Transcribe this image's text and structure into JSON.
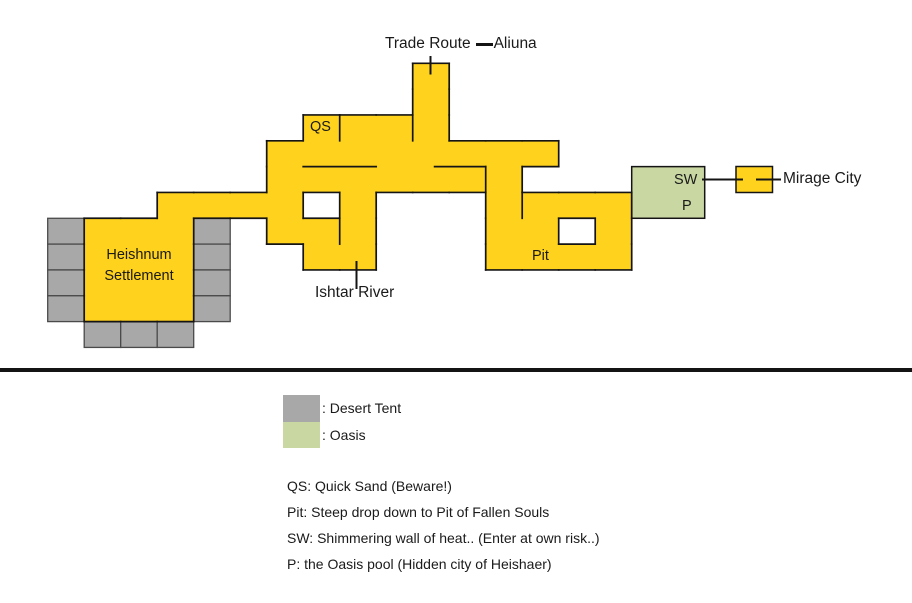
{
  "map": {
    "colors": {
      "path_fill": "#FFD21E",
      "outline": "#141414",
      "tent_fill": "#A8A8A8",
      "tent_stroke": "#4a4a4a",
      "oasis_fill": "#C9D7A2"
    },
    "grid": {
      "origin_x": 47.7,
      "origin_y": 63.3,
      "cell_w": 36.5,
      "cell_h": 25.83
    },
    "yellow_cells": [
      [
        10,
        0
      ],
      [
        10,
        1
      ],
      [
        7,
        2
      ],
      [
        8,
        2
      ],
      [
        9,
        2
      ],
      [
        10,
        2
      ],
      [
        6,
        3
      ],
      [
        7,
        3
      ],
      [
        8,
        3
      ],
      [
        9,
        3
      ],
      [
        10,
        3
      ],
      [
        11,
        3
      ],
      [
        12,
        3
      ],
      [
        13,
        3
      ],
      [
        6,
        4
      ],
      [
        7,
        4
      ],
      [
        8,
        4
      ],
      [
        9,
        4
      ],
      [
        10,
        4
      ],
      [
        11,
        4
      ],
      [
        12,
        4
      ],
      [
        3,
        5
      ],
      [
        4,
        5
      ],
      [
        5,
        5
      ],
      [
        6,
        5
      ],
      [
        8,
        5
      ],
      [
        12,
        5
      ],
      [
        13,
        5
      ],
      [
        14,
        5
      ],
      [
        15,
        5
      ],
      [
        1,
        6
      ],
      [
        2,
        6
      ],
      [
        3,
        6
      ],
      [
        6,
        6
      ],
      [
        7,
        6
      ],
      [
        8,
        6
      ],
      [
        12,
        6
      ],
      [
        13,
        6
      ],
      [
        15,
        6
      ],
      [
        1,
        7
      ],
      [
        2,
        7
      ],
      [
        3,
        7
      ],
      [
        7,
        7
      ],
      [
        8,
        7
      ],
      [
        12,
        7
      ],
      [
        13,
        7
      ],
      [
        14,
        7
      ],
      [
        15,
        7
      ],
      [
        1,
        8
      ],
      [
        2,
        8
      ],
      [
        3,
        8
      ],
      [
        1,
        9
      ],
      [
        2,
        9
      ],
      [
        3,
        9
      ]
    ],
    "tent_cells": [
      [
        0,
        6
      ],
      [
        0,
        7
      ],
      [
        0,
        8
      ],
      [
        0,
        9
      ],
      [
        4,
        6
      ],
      [
        4,
        7
      ],
      [
        4,
        8
      ],
      [
        4,
        9
      ],
      [
        1,
        10
      ],
      [
        2,
        10
      ],
      [
        3,
        10
      ]
    ],
    "walls": [
      [
        8,
        2,
        8,
        3
      ],
      [
        10,
        2,
        10,
        3
      ],
      [
        7,
        4,
        9,
        4
      ],
      [
        10.6,
        4,
        12,
        4
      ],
      [
        12,
        4,
        12,
        5
      ],
      [
        13,
        5,
        13,
        6
      ],
      [
        8,
        6,
        8,
        7
      ]
    ],
    "green_box": {
      "col": 16,
      "row": 4,
      "cols": 2,
      "rows": 2
    },
    "mirage_box": {
      "x": 736,
      "y": 166.5,
      "w": 36.5,
      "h": 26
    },
    "lines": [
      [
        430.5,
        57,
        430.5,
        73.5
      ],
      [
        356.5,
        262,
        356.5,
        288
      ],
      [
        703,
        179.5,
        742,
        179.5
      ],
      [
        757,
        179.5,
        780,
        179.5
      ]
    ],
    "labels": {
      "trade_route": "Trade Route",
      "aliuna": "Aliuna",
      "qs": "QS",
      "pit": "Pit",
      "sw": "SW",
      "p": "P",
      "heishnum_settlement": "Heishnum Settlement",
      "mirage_city": "Mirage City",
      "ishtar_river": "Ishtar River"
    }
  },
  "legend": {
    "swatches": [
      {
        "label": ": Desert Tent"
      },
      {
        "label": ": Oasis"
      }
    ],
    "notes": [
      "QS: Quick Sand (Beware!)",
      "Pit: Steep drop down to Pit of Fallen Souls",
      "SW: Shimmering wall of heat.. (Enter at own risk..)",
      "P: the Oasis pool (Hidden city of Heishaer)"
    ]
  }
}
